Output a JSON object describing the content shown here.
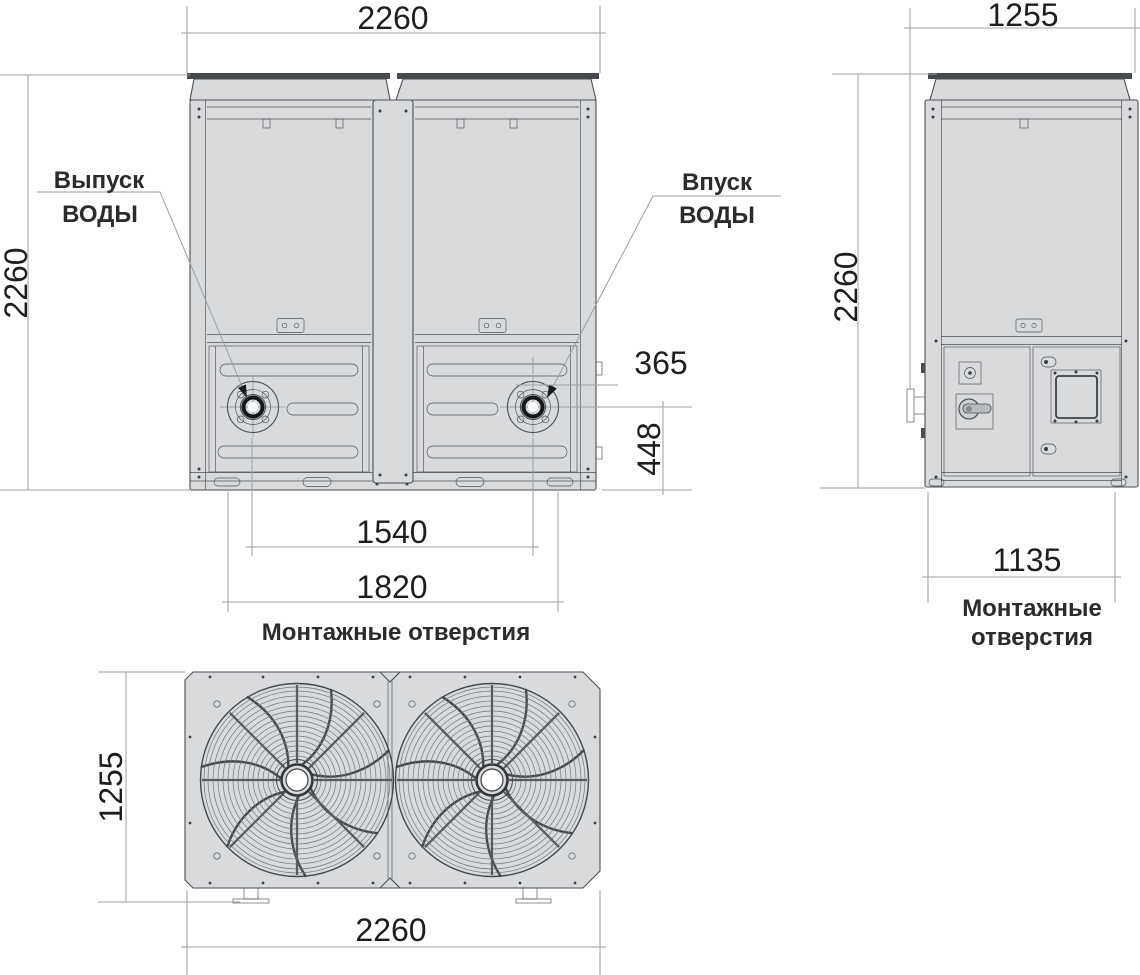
{
  "colors": {
    "body": "#d9dadb",
    "line": "#4a4f54",
    "band": "#46494d",
    "dim": "#9aa0a5",
    "ink": "#1c1e20"
  },
  "front_view": {
    "dim_width": "2260",
    "dim_height": "2260",
    "outlet_line1": "Выпуск",
    "outlet_line2": "ВОДЫ",
    "inlet_line1": "Впуск",
    "inlet_line2": "ВОДЫ",
    "dim_inlet_offset": "365",
    "dim_inlet_height": "448",
    "dim_pipe_spacing": "1540",
    "dim_mount_spacing": "1820",
    "mounting_label": "Монтажные отверстия"
  },
  "side_view": {
    "dim_depth": "1255",
    "dim_height": "2260",
    "dim_mount_spacing": "1135",
    "mounting_line1": "Монтажные",
    "mounting_line2": "отверстия"
  },
  "top_view": {
    "dim_depth": "1255",
    "dim_width": "2260"
  }
}
